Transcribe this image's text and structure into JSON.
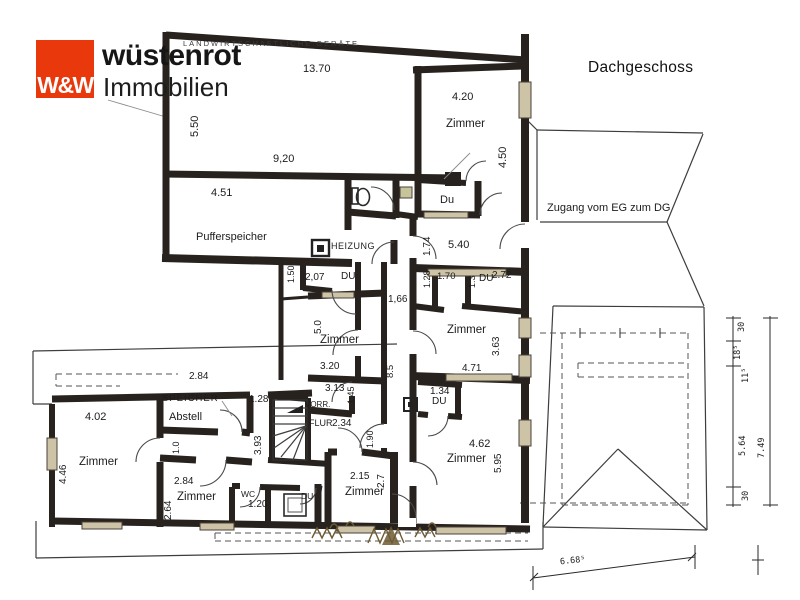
{
  "brand": {
    "mark": "W&W",
    "name": "wüstenrot",
    "suffix": "Immobilien",
    "accent": "#e8380c"
  },
  "title": "Dachgeschoss",
  "colors": {
    "wall": "#27221d",
    "window_fill": "#cdc3a6",
    "accent": "#e8380c",
    "vegetation": "#6d5a33",
    "paper": "#ffffff"
  },
  "labels": {
    "geraete": "LANDWIRTSCHAFTLICHE  GERÄTE",
    "puffer": "Pufferspeicher",
    "zimmer_tr": "Zimmer",
    "du_tr": "Du",
    "zugang": "Zugang vom EG zum DG",
    "heizung": "HEIZUNG",
    "du_a": "DU",
    "du_b": "DU",
    "du_c": "DU",
    "du_d": "DU",
    "zimmer_cl": "Zimmer",
    "zimmer_cr": "Zimmer",
    "vorr": "VORR.",
    "flur": "FLUR",
    "speicher": "SPEICHER",
    "abstell": "Abstell",
    "zimmer_l": "Zimmer",
    "zimmer_bs": "Zimmer",
    "wc": "WC",
    "zimmer_bc": "Zimmer",
    "zimmer_br": "Zimmer"
  },
  "dims": {
    "d1370": "13.70",
    "d550": "5.50",
    "d920": "9,20",
    "d451": "4.51",
    "d420": "4.20",
    "d450": "4.50",
    "d174": "1.74",
    "d540": "5.40",
    "d150": "1.50",
    "d207": "2,07",
    "d128v": "1.28",
    "d170": "1.70",
    "d13": "1.3",
    "d272": "2.72",
    "d166": "1,66",
    "d50": "5.0",
    "d320": "3.20",
    "d363": "3.63",
    "d471": "4.71",
    "d85": "8.5",
    "d313": "3.13",
    "d145": "1.45",
    "d234": "2.34",
    "d190": "1.90",
    "d134": "1.34",
    "d284a": "2.84",
    "d128h": "1.28",
    "d402": "4.02",
    "d446": "4.46",
    "d10": "1.0",
    "d393": "3.93",
    "d284b": "2.84",
    "d264": "2.64",
    "d120": "1.20",
    "d215": "2.15",
    "d27": "2.7",
    "d462": "4.62",
    "d595": "5.95",
    "c30t": "30",
    "c185": "18⁵",
    "c115": "11⁵",
    "c564": "5.64",
    "c749": "7.49",
    "c30b": "30",
    "c668": "6.68⁵"
  }
}
